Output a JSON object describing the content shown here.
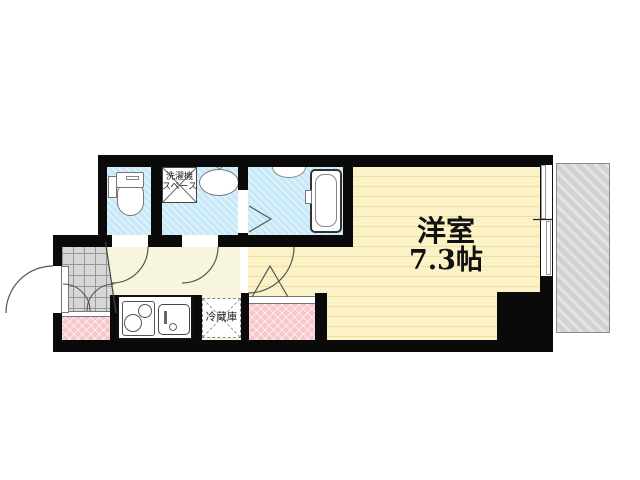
{
  "floorplan": {
    "room_label": "洋室",
    "room_size": "7.3帖",
    "washer_space_line1": "洗濯機",
    "washer_space_line2": "スペース",
    "fridge_label": "冷蔵庫",
    "colors": {
      "wall": "#0a0a0a",
      "wet_area_fill": "#c6e8f7",
      "room_fill": "#fbf3c7",
      "room_stripe": "#efdfa2",
      "hall_fill": "#f8f5dd",
      "entrance_tile": "#d6d6d6",
      "accent_pink": "#f7c6ca",
      "balcony_fill": "#d2d2d2"
    }
  }
}
